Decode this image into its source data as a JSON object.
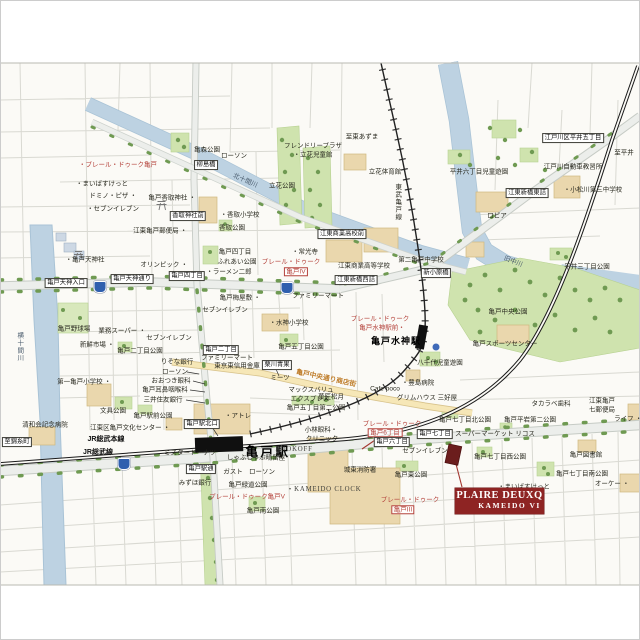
{
  "badge": {
    "line1": "PLAIRE DEUXQ",
    "line2": "KAMEIDO VI"
  },
  "colors": {
    "badge_bg": "#8e2423",
    "property_marker": "#6b1d1d",
    "red_label": "#b4423b",
    "park_green": "#cfe3ae",
    "river_blue": "#bdd2e2",
    "building_tan": "#ead7ad",
    "shop_street_yellow": "#f6e7b7",
    "route_shield_blue": "#2f5fae"
  },
  "map": {
    "railways": [
      "JR総武本線",
      "JR総武線",
      "東武亀戸線"
    ],
    "stations": [
      "亀戸駅",
      "亀戸水神駅"
    ],
    "rivers": [
      "横十間川",
      "北十間川",
      "旧中川"
    ],
    "labels": [
      {
        "t": "ローソン",
        "x": 234,
        "y": 156
      },
      {
        "t": "柳島橋",
        "x": 206,
        "y": 165,
        "c": "box"
      },
      {
        "t": "北十間川",
        "x": 245,
        "y": 181,
        "c": "riv",
        "r": 24
      },
      {
        "t": "亀森公園",
        "x": 207,
        "y": 150
      },
      {
        "t": "・プレール・ドゥーク亀戸",
        "x": 118,
        "y": 165,
        "c": "red"
      },
      {
        "t": "・まいばすけっと",
        "x": 102,
        "y": 184
      },
      {
        "t": "ドミノ・ピザ ・",
        "x": 113,
        "y": 196
      },
      {
        "t": "・セブンイレブン",
        "x": 113,
        "y": 209
      },
      {
        "t": "亀戸香取神社 ・",
        "x": 172,
        "y": 198
      },
      {
        "t": "香取神社前",
        "x": 188,
        "y": 216,
        "c": "box"
      },
      {
        "t": "・香取小学校",
        "x": 240,
        "y": 215
      },
      {
        "t": "香取公園",
        "x": 232,
        "y": 228
      },
      {
        "t": "江東亀戸郵便局 ・",
        "x": 160,
        "y": 231
      },
      {
        "t": "・亀戸天神社",
        "x": 85,
        "y": 260
      },
      {
        "t": "オリンピック ・",
        "x": 164,
        "y": 265
      },
      {
        "t": "亀戸四丁目",
        "x": 235,
        "y": 252
      },
      {
        "t": "ふれあい公園",
        "x": 237,
        "y": 262
      },
      {
        "t": "・ラーメン二郎",
        "x": 229,
        "y": 272
      },
      {
        "t": "フレンドリープラザ",
        "x": 313,
        "y": 146
      },
      {
        "t": "・立花児童館",
        "x": 313,
        "y": 155
      },
      {
        "t": "立花公園",
        "x": 282,
        "y": 186
      },
      {
        "t": "至東あずま",
        "x": 362,
        "y": 137
      },
      {
        "t": "立花体育館",
        "x": 385,
        "y": 172
      },
      {
        "t": "東武亀戸線",
        "x": 397,
        "y": 202,
        "c": "vert"
      },
      {
        "t": "・常光寺",
        "x": 305,
        "y": 252
      },
      {
        "t": "江東商業高校前",
        "x": 342,
        "y": 234,
        "c": "box"
      },
      {
        "t": "江東商業高等学校",
        "x": 364,
        "y": 266
      },
      {
        "t": "第二亀戸中学校",
        "x": 421,
        "y": 260
      },
      {
        "t": "プレール・ドゥーク",
        "x": 291,
        "y": 262,
        "c": "red"
      },
      {
        "t": "亀戸IV",
        "x": 296,
        "y": 272,
        "c": "redbox"
      },
      {
        "t": "平井六丁目児童遊園",
        "x": 479,
        "y": 172
      },
      {
        "t": "ロピア",
        "x": 497,
        "y": 216
      },
      {
        "t": "江戸川区平井五丁目",
        "x": 573,
        "y": 138,
        "c": "box"
      },
      {
        "t": "至平井",
        "x": 624,
        "y": 153
      },
      {
        "t": "江戸川自動車教習所",
        "x": 573,
        "y": 167
      },
      {
        "t": "・小松川第三中学校",
        "x": 593,
        "y": 190
      },
      {
        "t": "江東新橋東詰",
        "x": 527,
        "y": 193,
        "c": "box"
      },
      {
        "t": "旧中川",
        "x": 513,
        "y": 262,
        "c": "riv",
        "r": 22
      },
      {
        "t": "平井三丁目公園",
        "x": 587,
        "y": 267
      },
      {
        "t": "新小原橋",
        "x": 436,
        "y": 273,
        "c": "box"
      },
      {
        "t": "亀戸中央公園",
        "x": 508,
        "y": 312
      },
      {
        "t": "亀戸スポーツセンター",
        "x": 505,
        "y": 344
      },
      {
        "t": "八千代児童遊園",
        "x": 440,
        "y": 363
      },
      {
        "t": "亀戸水神駅",
        "x": 396,
        "y": 341,
        "c": "bold9"
      },
      {
        "t": "プレール・ドゥーク",
        "x": 380,
        "y": 319,
        "c": "red"
      },
      {
        "t": "亀戸水神駅前・",
        "x": 382,
        "y": 328,
        "c": "red"
      },
      {
        "t": "横十間川",
        "x": 19,
        "y": 347,
        "c": "vert riv"
      },
      {
        "t": "亀戸野球場",
        "x": 74,
        "y": 329
      },
      {
        "t": "亀戸天神入口",
        "x": 66,
        "y": 283,
        "c": "box"
      },
      {
        "t": "亀戸天神通り",
        "x": 132,
        "y": 279,
        "c": "box"
      },
      {
        "t": "亀戸四丁目",
        "x": 187,
        "y": 276,
        "c": "box"
      },
      {
        "t": "江東新橋西詰",
        "x": 356,
        "y": 280,
        "c": "box"
      },
      {
        "t": "ファミリーマート",
        "x": 318,
        "y": 296
      },
      {
        "t": "亀戸梅屋敷 ・",
        "x": 240,
        "y": 298
      },
      {
        "t": "セブンイレブン",
        "x": 225,
        "y": 310
      },
      {
        "t": "・水神小学校",
        "x": 289,
        "y": 323
      },
      {
        "t": "亀戸五丁目公園",
        "x": 301,
        "y": 347
      },
      {
        "t": "業務スーパー ・",
        "x": 122,
        "y": 331
      },
      {
        "t": "新鮮市場 ・",
        "x": 97,
        "y": 345
      },
      {
        "t": "亀戸二丁目公園",
        "x": 140,
        "y": 351
      },
      {
        "t": "セブンイレブン",
        "x": 169,
        "y": 338
      },
      {
        "t": "りそな銀行",
        "x": 177,
        "y": 362
      },
      {
        "t": "亀戸二丁目",
        "x": 221,
        "y": 350,
        "c": "box"
      },
      {
        "t": "ファミリーマート",
        "x": 227,
        "y": 358
      },
      {
        "t": "東京東信用金庫",
        "x": 237,
        "y": 366
      },
      {
        "t": "ローソン",
        "x": 175,
        "y": 372
      },
      {
        "t": "おおつき眼科",
        "x": 171,
        "y": 381
      },
      {
        "t": "亀戸耳鼻咽喉科",
        "x": 165,
        "y": 390
      },
      {
        "t": "三井住友銀行",
        "x": 163,
        "y": 400
      },
      {
        "t": "第一亀戸小学校 ・",
        "x": 84,
        "y": 382
      },
      {
        "t": "文具公園",
        "x": 113,
        "y": 411
      },
      {
        "t": "亀戸駅前公園",
        "x": 153,
        "y": 416
      },
      {
        "t": "江東区亀戸文化センター ・",
        "x": 130,
        "y": 428
      },
      {
        "t": "清和会記念病院",
        "x": 45,
        "y": 425
      },
      {
        "t": "栗川青果",
        "x": 277,
        "y": 365,
        "c": "box"
      },
      {
        "t": "ミーツ",
        "x": 280,
        "y": 378
      },
      {
        "t": "マックスバリュ",
        "x": 311,
        "y": 390
      },
      {
        "t": "エクスプレス",
        "x": 310,
        "y": 399
      },
      {
        "t": "亀戸中央通り商店街",
        "x": 326,
        "y": 379,
        "c": "gold",
        "r": 12
      },
      {
        "t": "Cafe poco",
        "x": 385,
        "y": 389
      },
      {
        "t": "菓匠松月",
        "x": 331,
        "y": 397
      },
      {
        "t": "・豊島病院",
        "x": 418,
        "y": 383
      },
      {
        "t": "グリムハウス 三好屋",
        "x": 427,
        "y": 398
      },
      {
        "t": "亀戸五丁目第二公園",
        "x": 316,
        "y": 408
      },
      {
        "t": "・アトレ",
        "x": 238,
        "y": 416
      },
      {
        "t": "亀戸駅北口",
        "x": 202,
        "y": 424,
        "c": "box"
      },
      {
        "t": "亀戸駅",
        "x": 268,
        "y": 452,
        "c": "bold13"
      },
      {
        "t": "JR総武本線",
        "x": 106,
        "y": 440,
        "c": "jr"
      },
      {
        "t": "JR総武線",
        "x": 98,
        "y": 453,
        "c": "jr"
      },
      {
        "t": "至錦糸町",
        "x": 17,
        "y": 442,
        "c": "box"
      },
      {
        "t": "ミスタードーナツ",
        "x": 190,
        "y": 453
      },
      {
        "t": "しゃぶしゃぶ晴留屋",
        "x": 256,
        "y": 458
      },
      {
        "t": "小林眼科・",
        "x": 321,
        "y": 430
      },
      {
        "t": "クリニック",
        "x": 322,
        "y": 439
      },
      {
        "t": "BOOKOFF",
        "x": 294,
        "y": 450,
        "c": "eng"
      },
      {
        "t": "亀戸駅通",
        "x": 201,
        "y": 469,
        "c": "box"
      },
      {
        "t": "ガスト",
        "x": 233,
        "y": 472
      },
      {
        "t": "ローソン",
        "x": 262,
        "y": 472
      },
      {
        "t": "みずほ銀行",
        "x": 195,
        "y": 483
      },
      {
        "t": "亀戸緑道公園",
        "x": 248,
        "y": 485
      },
      {
        "t": "プレール・ドゥーク亀戸V",
        "x": 247,
        "y": 497,
        "c": "red"
      },
      {
        "t": "亀戸南公園",
        "x": 263,
        "y": 511
      },
      {
        "t": "・KAMEIDO CLOCK",
        "x": 324,
        "y": 490,
        "c": "eng"
      },
      {
        "t": "城東消防署",
        "x": 360,
        "y": 470
      },
      {
        "t": "亀戸東公園",
        "x": 411,
        "y": 475
      },
      {
        "t": "プレール・ドゥーク",
        "x": 392,
        "y": 424,
        "c": "red"
      },
      {
        "t": "亀戸6丁目",
        "x": 385,
        "y": 433,
        "c": "redbox"
      },
      {
        "t": "亀戸六丁目",
        "x": 392,
        "y": 442,
        "c": "box"
      },
      {
        "t": "セブンイレブン",
        "x": 425,
        "y": 451
      },
      {
        "t": "亀戸七丁目",
        "x": 435,
        "y": 434,
        "c": "box"
      },
      {
        "t": "スーパーマーケット リコス",
        "x": 495,
        "y": 434
      },
      {
        "t": "亀戸七丁目北公園",
        "x": 465,
        "y": 420
      },
      {
        "t": "亀戸七丁目西公園",
        "x": 500,
        "y": 457
      },
      {
        "t": "・まいばすけっと",
        "x": 524,
        "y": 487
      },
      {
        "t": "プレール・ドゥーク",
        "x": 410,
        "y": 500,
        "c": "red"
      },
      {
        "t": "亀戸III",
        "x": 403,
        "y": 510,
        "c": "redbox"
      },
      {
        "t": "タカラベ歯科",
        "x": 551,
        "y": 404
      },
      {
        "t": "江東亀戸",
        "x": 602,
        "y": 401
      },
      {
        "t": "七郵便局",
        "x": 602,
        "y": 410
      },
      {
        "t": "亀戸平岩第二公園",
        "x": 530,
        "y": 420
      },
      {
        "t": "ライフ ・",
        "x": 628,
        "y": 419
      },
      {
        "t": "亀戸図書館",
        "x": 586,
        "y": 455
      },
      {
        "t": "亀戸七丁目南公園",
        "x": 582,
        "y": 474
      },
      {
        "t": "オーケー ・",
        "x": 612,
        "y": 484
      }
    ],
    "shields": [
      {
        "x": 100,
        "y": 287
      },
      {
        "x": 287,
        "y": 288
      },
      {
        "x": 124,
        "y": 464
      }
    ]
  }
}
